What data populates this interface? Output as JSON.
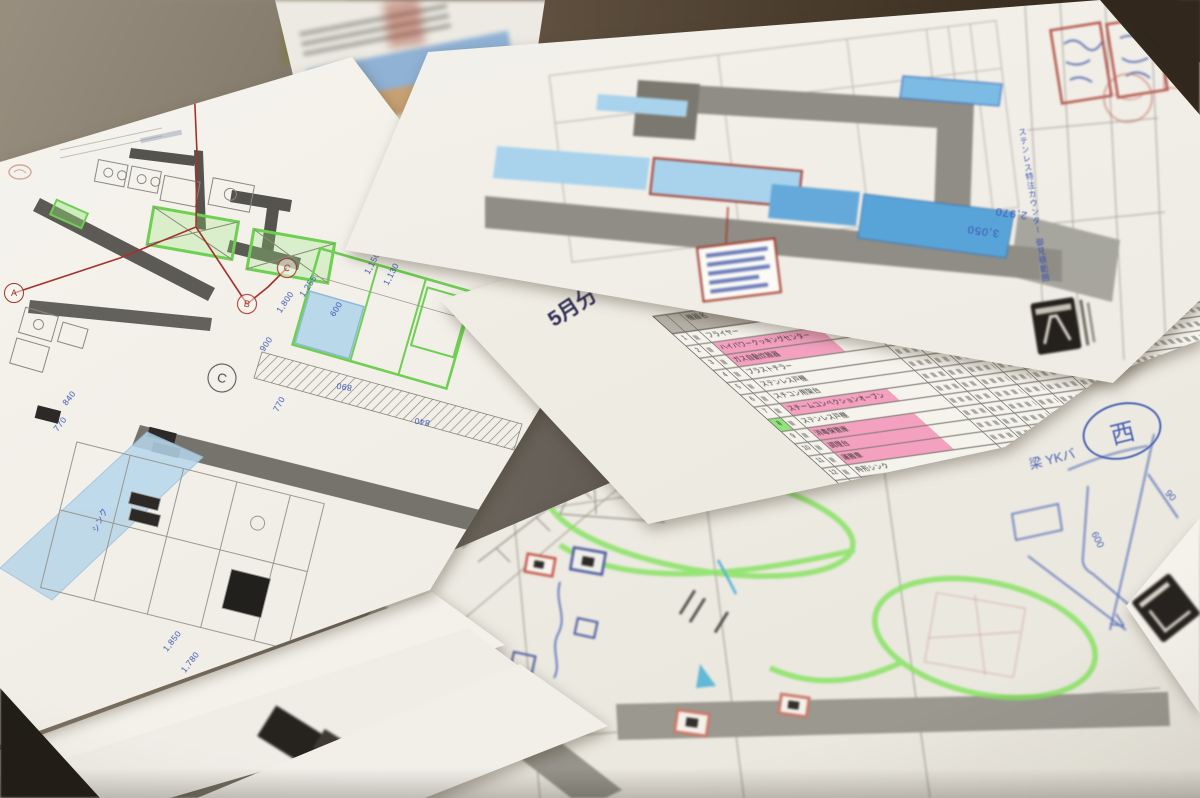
{
  "colors": {
    "highlighter_green": "#82e35c",
    "highlighter_pink": "#f36ea5",
    "counter_blue_dark": "#58a4d8",
    "counter_blue_light": "#a9d2ec",
    "section_red": "#a4322a",
    "ink_blue": "#3a55b4",
    "stamp_red": "#b4574d",
    "pen_blue": "#4a63b5"
  },
  "left_sheet": {
    "section_markers": {
      "a": "A",
      "b": "B",
      "c": "C"
    },
    "detail_marker": "C",
    "sink_label": "シンク",
    "dims": {
      "d1": "1,850",
      "d2": "1,780",
      "d3": "940",
      "d4": "770",
      "d5": "840",
      "d6": "900",
      "d7": "1,800",
      "d8": "1,255",
      "d9": "770",
      "d10": "890",
      "d11": "840",
      "d12": "1,130",
      "d13": "1,150",
      "d14": "600",
      "d15": "770"
    }
  },
  "top_right_sheet": {
    "dims": {
      "d1": "3,050",
      "d2": "2,970"
    },
    "side_note": "ステンレス特注カウンター 御見積範囲"
  },
  "spec_sheet": {
    "handwritten_month": "5月分",
    "table": {
      "name_header": "機器名",
      "rows": [
        {
          "no": "1",
          "name": "フライヤー",
          "hl": ""
        },
        {
          "no": "2",
          "name": "ハイパワークッキングセンター",
          "hl": "pink"
        },
        {
          "no": "3",
          "name": "ガス自動炊飯器",
          "hl": "pink"
        },
        {
          "no": "4",
          "name": "ブラストチラー",
          "hl": ""
        },
        {
          "no": "5",
          "name": "ステンレス戸棚",
          "hl": ""
        },
        {
          "no": "6",
          "name": "スチコン用架台",
          "hl": ""
        },
        {
          "no": "7",
          "name": "スチームコンベクションオーブン",
          "hl": "pink"
        },
        {
          "no": "8",
          "name": "ステンレス戸棚",
          "hl": "green"
        },
        {
          "no": "9",
          "name": "消毒保管庫",
          "hl": "pink"
        },
        {
          "no": "10",
          "name": "調理台",
          "hl": "pink"
        },
        {
          "no": "11",
          "name": "運搬車",
          "hl": "pink"
        },
        {
          "no": "12",
          "name": "舟形シンク",
          "hl": ""
        },
        {
          "no": "13",
          "name": "ガラス戸ケース",
          "hl": "pink"
        },
        {
          "no": "14",
          "name": "一槽シンク",
          "hl": "green"
        },
        {
          "no": "15",
          "name": "ガスレンジ",
          "hl": "pink"
        }
      ]
    }
  },
  "bottom_sheet": {
    "title_block": {
      "scale_label": "縮尺",
      "scale_value": "1/30 (A3)",
      "date_label": "作成日",
      "date_value": "2021/01/13",
      "drawing_no": "B1",
      "key_plan_label": "KEY"
    },
    "handwriting": {
      "circled_char": "西",
      "note": "梁 YKバ",
      "dim_a": "600",
      "dim_b": "90"
    }
  }
}
